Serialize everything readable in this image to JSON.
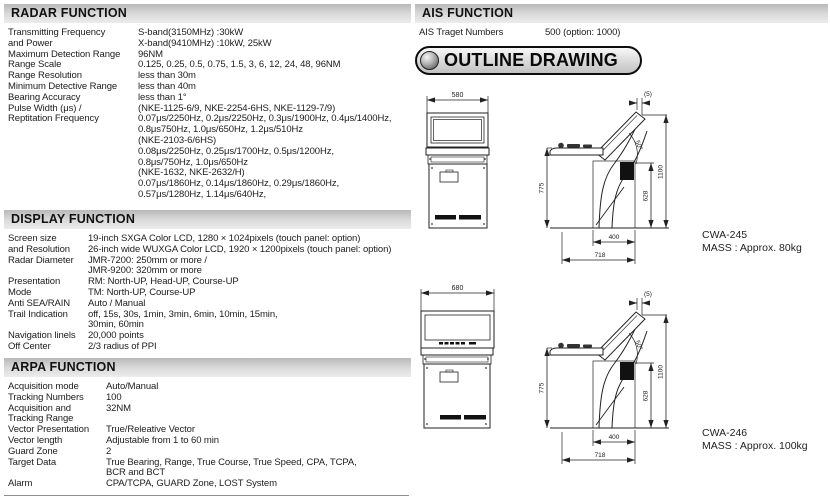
{
  "colors": {
    "header_bar": "#d9d9d9",
    "ink": "#1c1c1c",
    "drawing_line": "#222222"
  },
  "sections": {
    "radar": {
      "title": "RADAR FUNCTION",
      "rows": [
        {
          "label": "Transmitting Frequency",
          "value": "S-band(3150MHz) :30kW"
        },
        {
          "label": "and Power",
          "value": "X-band(9410MHz) :10kW, 25kW"
        },
        {
          "label": "Maximum Detection Range",
          "value": "96NM"
        },
        {
          "label": "Range Scale",
          "value": "0.125, 0.25, 0.5, 0.75, 1.5, 3, 6, 12, 24, 48, 96NM"
        },
        {
          "label": "Range Resolution",
          "value": "less than 30m"
        },
        {
          "label": "Minimum Detective Range",
          "value": "less than 40m"
        },
        {
          "label": "Bearing Accuracy",
          "value": "less than 1°"
        },
        {
          "label": "Pulse Width (μs) /",
          "value": "(NKE-1125-6/9, NKE-2254-6HS, NKE-1129-7/9)"
        },
        {
          "label": "Reptitation Frequency",
          "value": "0.07μs/2250Hz, 0.2μs/2250Hz, 0.3μs/1900Hz, 0.4μs/1400Hz,"
        },
        {
          "label": "",
          "value": "0.8μs750Hz, 1.0μs/650Hz, 1.2μs/510Hz"
        },
        {
          "label": "",
          "value": "(NKE-2103-6/6HS)"
        },
        {
          "label": "",
          "value": "0.08μs/2250Hz, 0.25μs/1700Hz, 0.5μs/1200Hz,"
        },
        {
          "label": "",
          "value": "0.8μs/750Hz, 1.0μs/650Hz"
        },
        {
          "label": "",
          "value": "(NKE-1632, NKE-2632/H)"
        },
        {
          "label": "",
          "value": "0.07μs/1860Hz, 0.14μs/1860Hz, 0.29μs/1860Hz,"
        },
        {
          "label": "",
          "value": "0.57μs/1280Hz, 1.14μs/640Hz,"
        }
      ]
    },
    "display": {
      "title": "DISPLAY FUNCTION",
      "rows": [
        {
          "label": "Screen size",
          "value": "19-inch SXGA Color LCD, 1280 × 1024pixels (touch panel: option)"
        },
        {
          "label": "and Resolution",
          "value": "26-inch wide WUXGA Color LCD, 1920 × 1200pixels (touch panel: option)"
        },
        {
          "label": "Radar Diameter",
          "value": "JMR-7200: 250mm or more /"
        },
        {
          "label": "",
          "value": "JMR-9200: 320mm or more"
        },
        {
          "label": "Presentation",
          "value": "RM: North-UP, Head-UP, Course-UP"
        },
        {
          "label": "Mode",
          "value": "TM: North-UP, Course-UP"
        },
        {
          "label": "Anti SEA/RAIN",
          "value": "Auto / Manual"
        },
        {
          "label": "Trail Indication",
          "value": "off, 15s, 30s, 1min, 3min, 6min, 10min, 15min,"
        },
        {
          "label": "",
          "value": "30min, 60min"
        },
        {
          "label": "Navigation linels",
          "value": "20,000 points"
        },
        {
          "label": "Off Center",
          "value": "2/3 radius of PPI"
        }
      ]
    },
    "arpa": {
      "title": "ARPA FUNCTION",
      "rows": [
        {
          "label": "Acquisition mode",
          "value": "Auto/Manual"
        },
        {
          "label": "Tracking Numbers",
          "value": "100"
        },
        {
          "label": "Acquisition and",
          "value": "32NM"
        },
        {
          "label": "Tracking Range",
          "value": ""
        },
        {
          "label": "Vector Presentation",
          "value": "True/Releative Vector"
        },
        {
          "label": "Vector length",
          "value": "Adjustable from 1 to 60 min"
        },
        {
          "label": "Guard Zone",
          "value": "2"
        },
        {
          "label": "Target Data",
          "value": "True Bearing, Range, True Course, True Speed, CPA, TCPA,"
        },
        {
          "label": "",
          "value": "BCR and BCT"
        },
        {
          "label": "Alarm",
          "value": "CPA/TCPA, GUARD Zone, LOST System"
        }
      ]
    },
    "ais": {
      "title": "AIS FUNCTION",
      "rows": [
        {
          "label": "AIS Traget Numbers",
          "value": "500 (option: 1000)"
        }
      ]
    }
  },
  "outline": {
    "button_label": "OUTLINE DRAWING",
    "side_dims": {
      "top_offset": "(5)",
      "angle": "50°",
      "shelf_height": "775",
      "total_height": "1100",
      "bracket_height": "628",
      "base_width": "400",
      "base_depth": "718"
    },
    "drawings": [
      {
        "model": "CWA-245",
        "mass": "MASS : Approx. 80kg",
        "front_width": "580"
      },
      {
        "model": "CWA-246",
        "mass": "MASS : Approx. 100kg",
        "front_width": "680"
      }
    ]
  }
}
